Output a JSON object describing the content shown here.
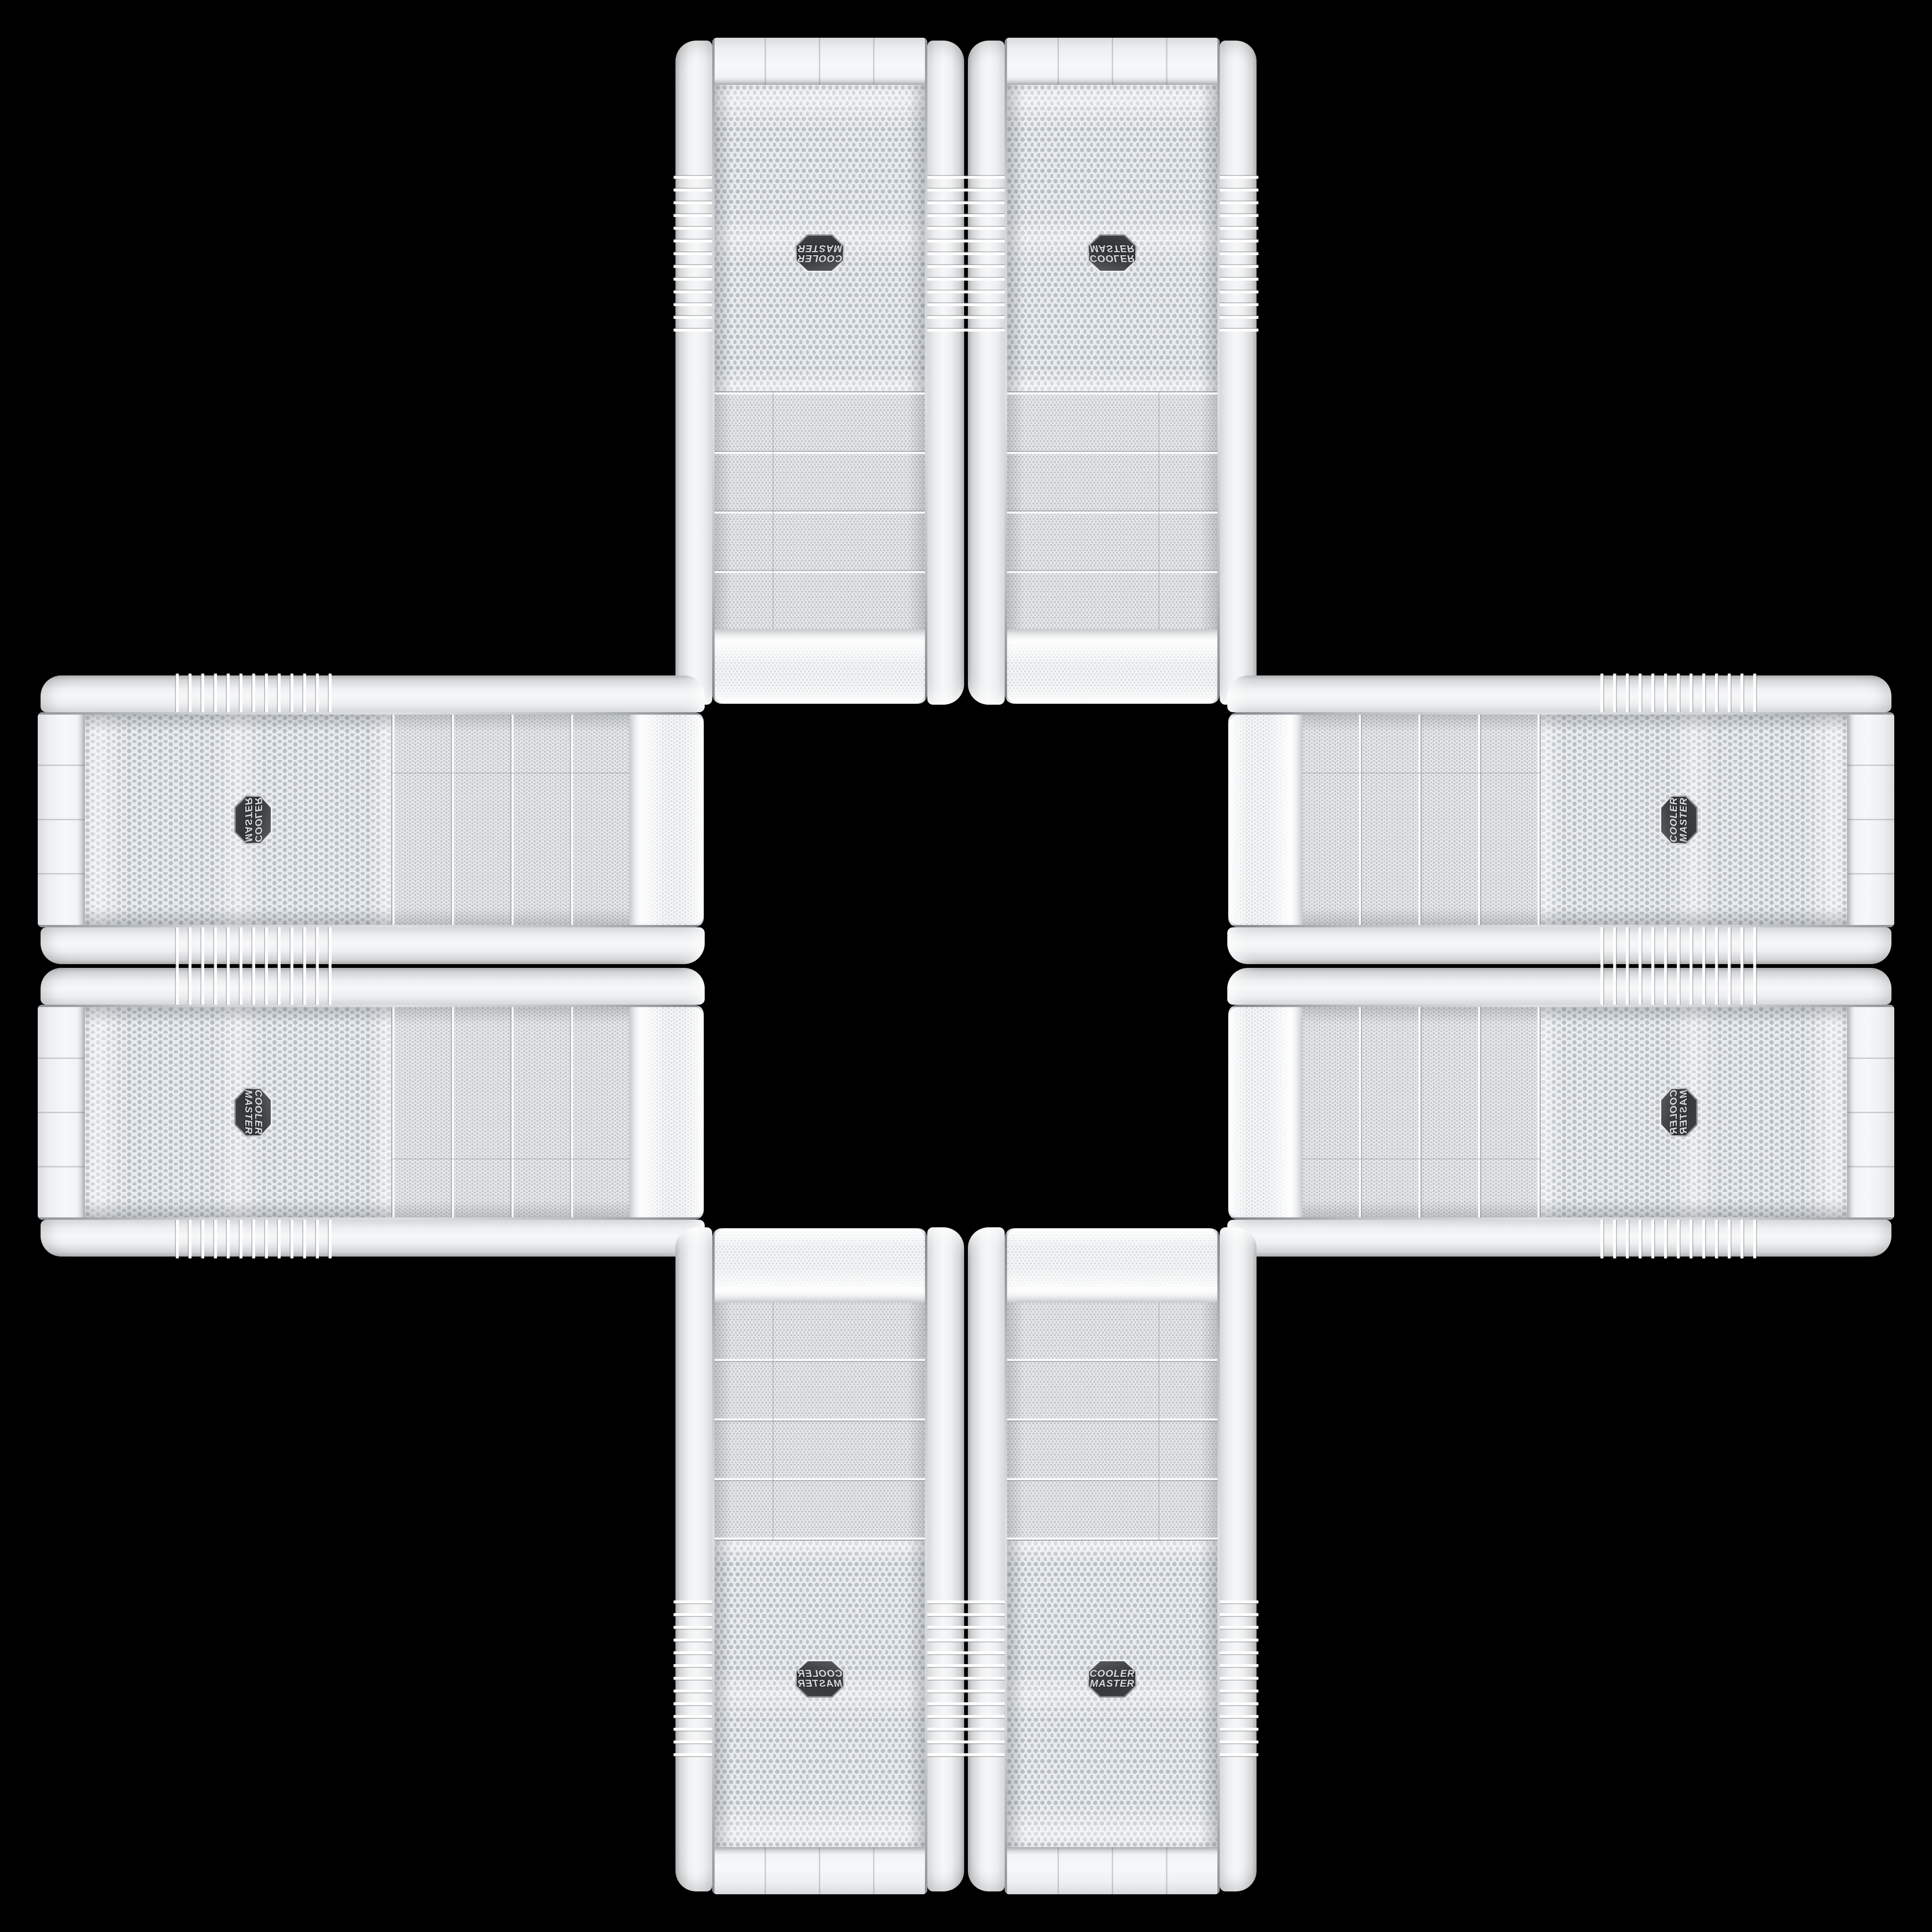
{
  "scene": {
    "background_color": "#000000",
    "description": "Eight identical white Cooler Master PC tower front panels arranged in a plus / cross pattern on a black background",
    "pattern": "plus-cross, two cases per arm, mirrored and rotated copies of one case"
  },
  "brand_badge": {
    "line1": "COOLER",
    "line2": "MASTER",
    "badge_color": "#35383a",
    "text_color": "#d9dbdd"
  },
  "colors": {
    "shell_white": "#f2f3f5",
    "mesh_background": "#e9ecee",
    "mesh_hole_coarse": "#b9bfc4",
    "mesh_hole_fine": "#c2c7ca",
    "chrome_trim": "#9aa0a4",
    "background": "#000000"
  },
  "cases": [
    {
      "id": "top-left",
      "arm": "top",
      "orientation": "vertical, rotated 180°, badge upside-down"
    },
    {
      "id": "top-right",
      "arm": "top",
      "orientation": "vertical, flipped vertically, badge upside-down"
    },
    {
      "id": "left-top",
      "arm": "left",
      "orientation": "horizontal, rotated 90° CW and flipped, badge left of center"
    },
    {
      "id": "left-bottom",
      "arm": "left",
      "orientation": "horizontal, rotated 90° CW, badge left of center"
    },
    {
      "id": "right-top",
      "arm": "right",
      "orientation": "horizontal, rotated 90° CCW, badge right of center"
    },
    {
      "id": "right-bottom",
      "arm": "right",
      "orientation": "horizontal, rotated 90° CCW and flipped, badge right of center"
    },
    {
      "id": "bottom-left",
      "arm": "bottom",
      "orientation": "vertical, mirrored horizontally, badge upright mirrored"
    },
    {
      "id": "bottom-right",
      "arm": "bottom",
      "orientation": "vertical, upright, badge readable"
    }
  ]
}
